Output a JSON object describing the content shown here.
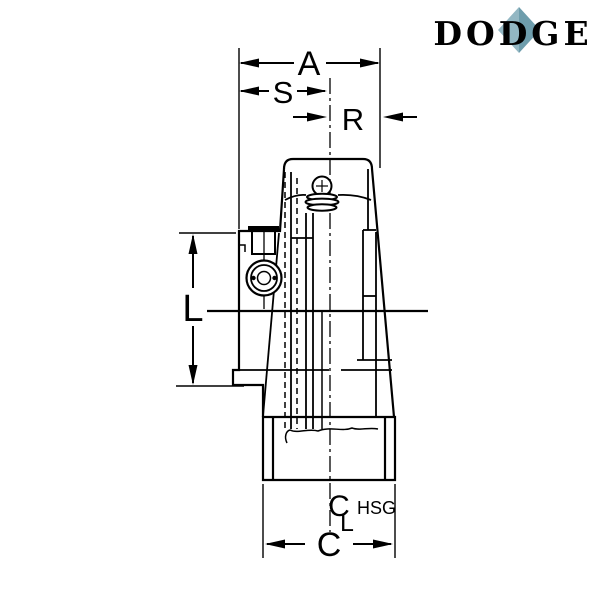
{
  "logo": {
    "text": "DODGE",
    "text_color": "#2e6577",
    "diamond_left_color": "#93b7c3",
    "diamond_right_color": "#6e9dac"
  },
  "labels": {
    "dim_a": "A",
    "dim_s": "S",
    "dim_r": "R",
    "dim_l": "L",
    "dim_c": "C",
    "housing_centerline_c": "C",
    "housing_centerline_l": "L",
    "housing_centerline_suffix": "HSG"
  },
  "drawing": {
    "line_color": "#000000",
    "background_color": "#ffffff"
  }
}
